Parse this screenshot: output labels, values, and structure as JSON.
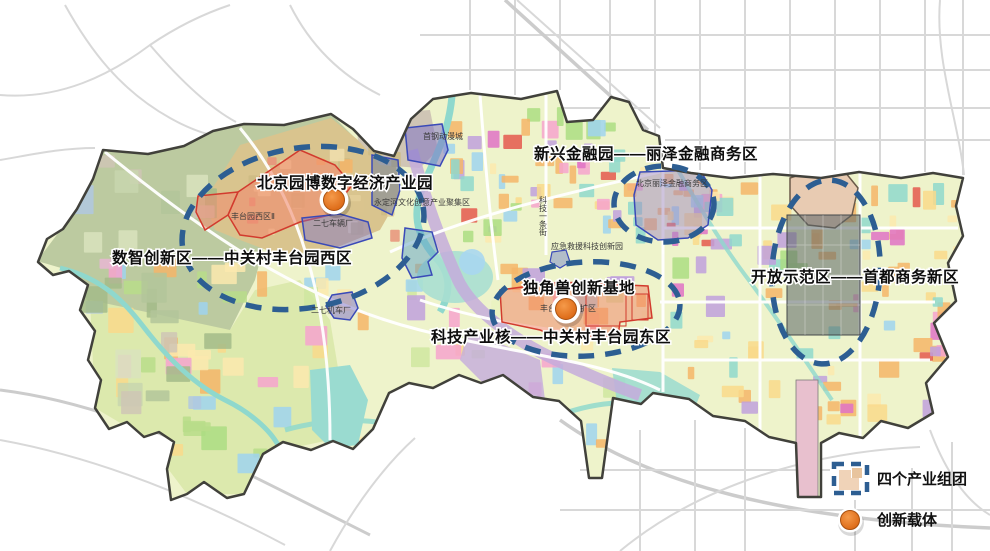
{
  "map": {
    "title_hint": "丰台区产业空间布局图",
    "region_labels": {
      "yuanbo_park": "北京园博数字经济产业园",
      "west_zone": "数智创新区——中关村丰台园西区",
      "lize": "新兴金融园——丽泽金融商务区",
      "unicorn": "独角兽创新基地",
      "east_zone": "科技产业核——中关村丰台园东区",
      "cbd": "开放示范区——首都商务新区"
    },
    "site_labels": {
      "fengtai_west_ii": "丰台园西区Ⅱ",
      "erqi_rolling_stock": "二七车辆厂",
      "erqi_locomotive": "二七机车厂",
      "shougang_anime": "首钢动漫城",
      "yongding_river_zone": "永定河文化创意产业聚集区",
      "lize_cbd": "北京丽泽金融商务区",
      "emergency_park": "应急救援科技创新园",
      "tech_street": "科技一条街",
      "east_expansion": "丰台园东区扩区"
    },
    "legend": {
      "cluster_label": "四个产业组团",
      "carrier_label": "创新载体"
    },
    "colors": {
      "cluster_outline_blue": "#2d5e92",
      "carrier_orange": "#e06f1f",
      "district_boundary": "#41413b",
      "red_zone_outline": "#d23b2e",
      "blue_zone_outline": "#3a4ab8",
      "water_teal": "#8fd8cd",
      "rail_purple": "#c4abdc"
    }
  }
}
